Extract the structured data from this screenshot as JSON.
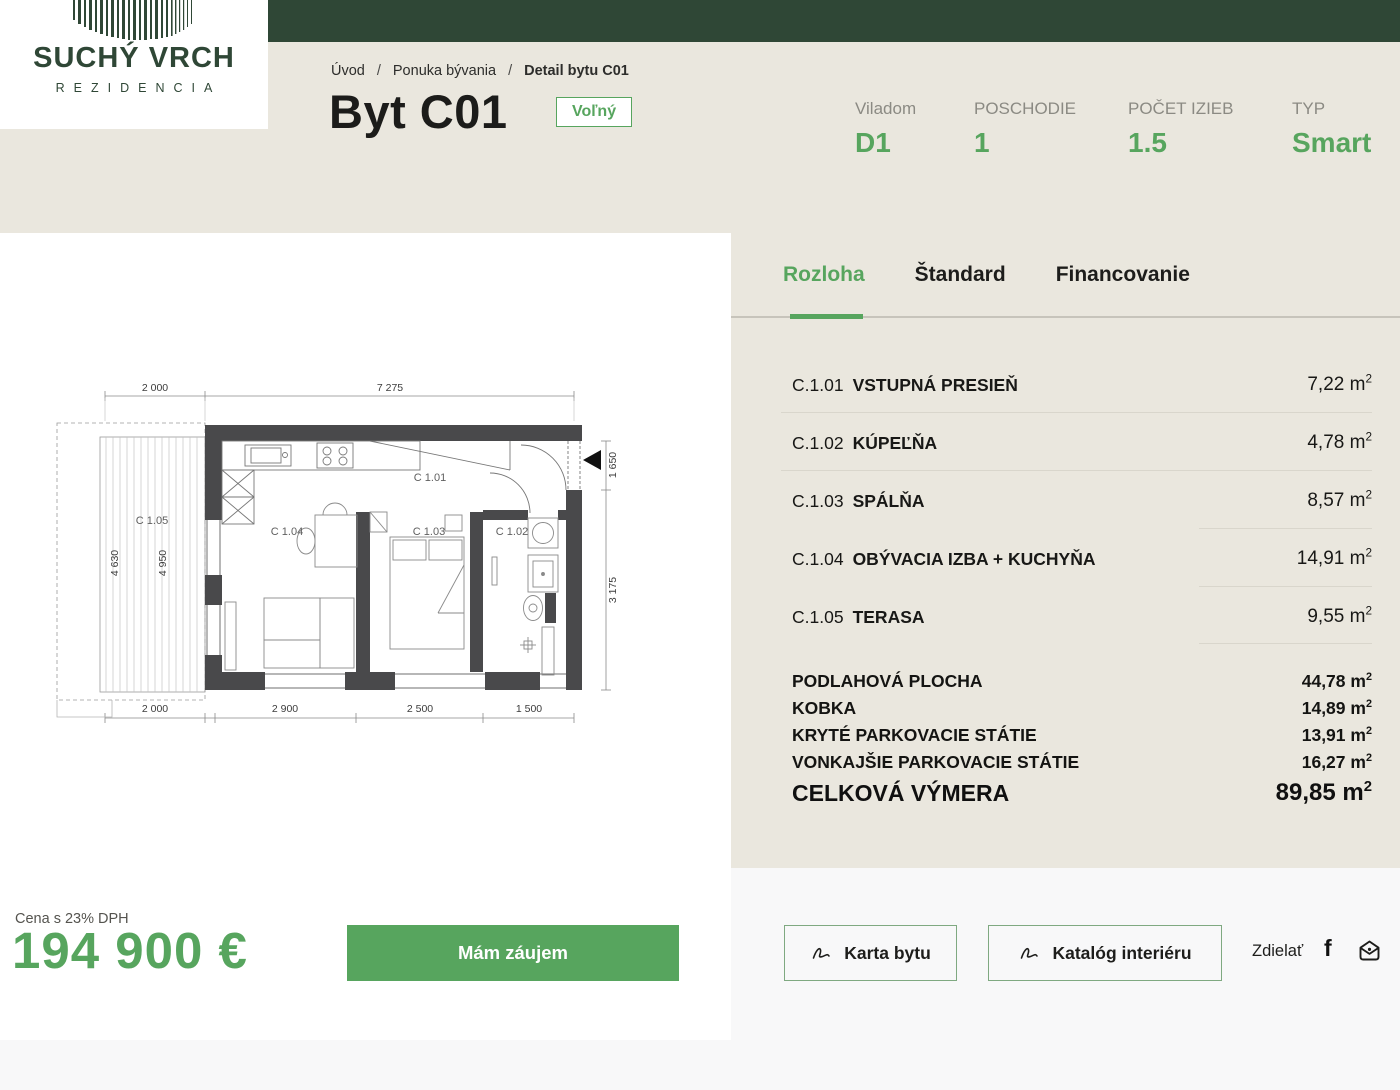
{
  "colors": {
    "accent": "#57a55e",
    "dark_green": "#2f4736",
    "beige": "#eae7de",
    "page_bg": "#f8f8f9"
  },
  "brand": {
    "line1": "SUCHÝ VRCH",
    "line2": "REZIDENCIA"
  },
  "breadcrumb": {
    "separator": "/",
    "items": [
      "Úvod",
      "Ponuka bývania"
    ],
    "current": "Detail bytu C01"
  },
  "header": {
    "title": "Byt C01",
    "badge": "Voľný",
    "info": [
      {
        "label": "Viladom",
        "value": "D1"
      },
      {
        "label": "POSCHODIE",
        "value": "1"
      },
      {
        "label": "POČET IZIEB",
        "value": "1.5"
      },
      {
        "label": "TYP",
        "value": "Smart"
      }
    ]
  },
  "tabs": [
    {
      "label": "Rozloha"
    },
    {
      "label": "Štandard"
    },
    {
      "label": "Financovanie"
    }
  ],
  "units": {
    "m": " m",
    "sup": "2"
  },
  "rooms": [
    {
      "code": "C.1.01",
      "name": "VSTUPNÁ PRESIEŇ",
      "area": "7,22"
    },
    {
      "code": "C.1.02",
      "name": "KÚPEĽŇA",
      "area": "4,78"
    },
    {
      "code": "C.1.03",
      "name": "SPÁLŇA",
      "area": "8,57"
    },
    {
      "code": "C.1.04",
      "name": "OBÝVACIA IZBA + KUCHYŇA",
      "area": "14,91"
    },
    {
      "code": "C.1.05",
      "name": "TERASA",
      "area": "9,55"
    }
  ],
  "totals": [
    {
      "label": "PODLAHOVÁ PLOCHA",
      "area": "44,78"
    },
    {
      "label": "KOBKA",
      "area": "14,89"
    },
    {
      "label": "KRYTÉ PARKOVACIE STÁTIE",
      "area": "13,91"
    },
    {
      "label": "VONKAJŠIE PARKOVACIE STÁTIE",
      "area": "16,27"
    }
  ],
  "grand_total": {
    "label": "CELKOVÁ VÝMERA",
    "area": "89,85"
  },
  "price": {
    "note": "Cena s 23% DPH",
    "value": "194 900 €",
    "cta": "Mám záujem"
  },
  "actions": {
    "buttons": [
      {
        "label": "Karta bytu"
      },
      {
        "label": "Katalóg interiéru"
      }
    ],
    "share_label": "Zdielať"
  },
  "floorplan": {
    "rooms": {
      "c101": "C 1.01",
      "c102": "C 1.02",
      "c103": "C 1.03",
      "c104": "C 1.04",
      "c105": "C 1.05"
    },
    "dims": {
      "top1": "2 000",
      "top2": "7 275",
      "bottom1": "2 000",
      "bottom2": "2 900",
      "bottom3": "2 500",
      "bottom4": "1 500",
      "terrace1": "4 630",
      "terrace2": "4 950",
      "right1": "1 650",
      "right2": "3 175"
    }
  }
}
